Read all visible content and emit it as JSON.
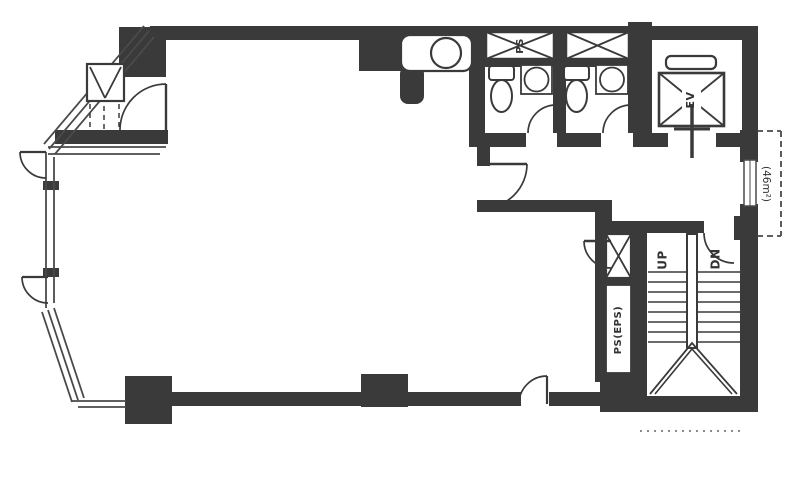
{
  "plan": {
    "labels": {
      "pipe_shaft": "PS",
      "elevator": "EV",
      "stair_up": "UP",
      "stair_down": "DN",
      "eps_shaft": "PS(EPS)",
      "area_annotation": "(46m²)"
    },
    "colors": {
      "ink": "#3a3a3a",
      "paper": "#ffffff"
    }
  }
}
